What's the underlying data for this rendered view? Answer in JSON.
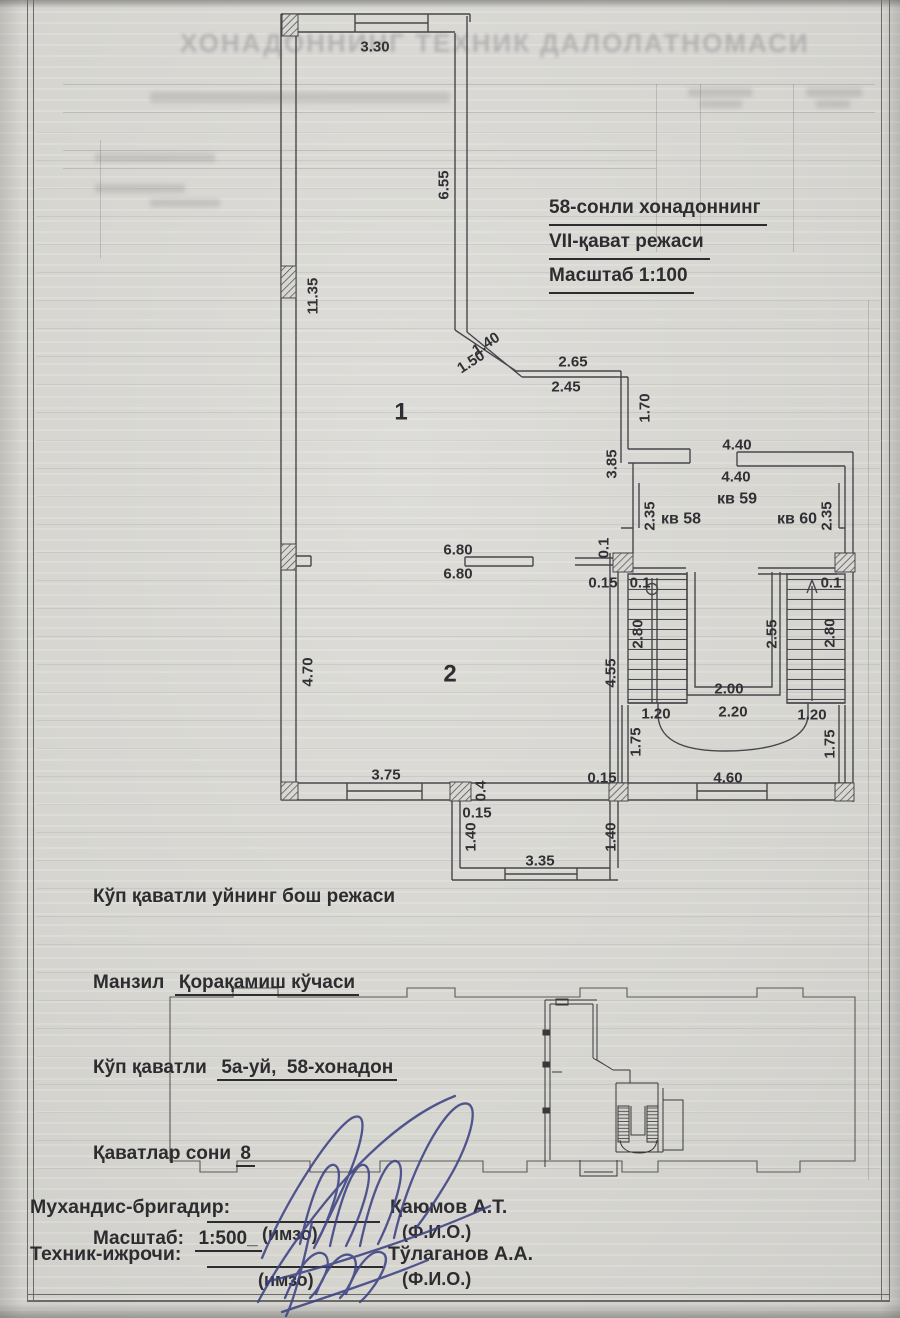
{
  "document": {
    "ghost_title": "ХОНАДОННИНГ ТЕХНИК ДАЛОЛАТНОМАСИ",
    "plan_title": {
      "line1": "58-сонли хонадоннинг",
      "line2": "VII-қават режаси",
      "line3": "Масштаб 1:100"
    },
    "site_info": {
      "line1": "Кўп қаватли уйнинг бош режаси",
      "address_label": "Манзил",
      "address_value": "Қорақамиш кўчаси",
      "building_label": "Кўп қаватли",
      "building_value": "5а-уй,  58-хонадон",
      "floors_label": "Қаватлар сони",
      "floors_value": "8",
      "scale_label": "Масштаб:",
      "scale_value": "1:500_"
    },
    "signatures": {
      "row1": {
        "role": "Мухандис-бригадир:",
        "sig_caption": "(имзо)",
        "name": "Қаюмов А.Т.",
        "fio_caption": "(Ф.И.О.)"
      },
      "row2": {
        "role": "Техник-ижрочи:",
        "sig_caption": "(имзо)",
        "name": "Тўлаганов А.А.",
        "fio_caption": "(Ф.И.О.)"
      }
    }
  },
  "plan": {
    "apartment_units": [
      "кв 58",
      "кв 59",
      "кв 60"
    ],
    "labels": [
      {
        "t": "3.30",
        "x": 375,
        "y": 47,
        "r": 0
      },
      {
        "t": "6.55",
        "x": 444,
        "y": 185,
        "r": -90
      },
      {
        "t": "11.35",
        "x": 313,
        "y": 296,
        "r": -90
      },
      {
        "t": "1.40",
        "x": 486,
        "y": 344,
        "r": -33
      },
      {
        "t": "1.50",
        "x": 471,
        "y": 362,
        "r": -33
      },
      {
        "t": "2.65",
        "x": 573,
        "y": 362,
        "r": 0
      },
      {
        "t": "2.45",
        "x": 566,
        "y": 387,
        "r": 0
      },
      {
        "t": "1.70",
        "x": 645,
        "y": 408,
        "r": -90
      },
      {
        "t": "3.85",
        "x": 612,
        "y": 464,
        "r": -90
      },
      {
        "t": "4.40",
        "x": 737,
        "y": 445,
        "r": 0
      },
      {
        "t": "4.40",
        "x": 736,
        "y": 477,
        "r": 0
      },
      {
        "t": "кв 59",
        "x": 737,
        "y": 499,
        "r": 0,
        "cls": "kv"
      },
      {
        "t": "кв 58",
        "x": 681,
        "y": 519,
        "r": 0,
        "cls": "kv"
      },
      {
        "t": "кв 60",
        "x": 797,
        "y": 519,
        "r": 0,
        "cls": "kv"
      },
      {
        "t": "2.35",
        "x": 650,
        "y": 516,
        "r": -90
      },
      {
        "t": "2.35",
        "x": 827,
        "y": 516,
        "r": -90
      },
      {
        "t": "0.1",
        "x": 604,
        "y": 548,
        "r": -90
      },
      {
        "t": "0.15",
        "x": 603,
        "y": 583,
        "r": 0
      },
      {
        "t": "0.1",
        "x": 640,
        "y": 583,
        "r": 0
      },
      {
        "t": "0.1",
        "x": 831,
        "y": 583,
        "r": 0
      },
      {
        "t": "2.80",
        "x": 638,
        "y": 634,
        "r": -90
      },
      {
        "t": "2.55",
        "x": 772,
        "y": 634,
        "r": -90
      },
      {
        "t": "2.80",
        "x": 830,
        "y": 633,
        "r": -90
      },
      {
        "t": "4.55",
        "x": 611,
        "y": 673,
        "r": -90
      },
      {
        "t": "2.00",
        "x": 729,
        "y": 689,
        "r": 0
      },
      {
        "t": "1.20",
        "x": 656,
        "y": 714,
        "r": 0
      },
      {
        "t": "2.20",
        "x": 733,
        "y": 712,
        "r": 0
      },
      {
        "t": "1.20",
        "x": 812,
        "y": 715,
        "r": 0
      },
      {
        "t": "1.75",
        "x": 636,
        "y": 742,
        "r": -90
      },
      {
        "t": "1.75",
        "x": 830,
        "y": 744,
        "r": -90
      },
      {
        "t": "0.15",
        "x": 602,
        "y": 778,
        "r": 0
      },
      {
        "t": "4.60",
        "x": 728,
        "y": 778,
        "r": 0
      },
      {
        "t": "6.80",
        "x": 458,
        "y": 550,
        "r": 0
      },
      {
        "t": "6.80",
        "x": 458,
        "y": 574,
        "r": 0
      },
      {
        "t": "4.70",
        "x": 308,
        "y": 672,
        "r": -90
      },
      {
        "t": "3.75",
        "x": 386,
        "y": 775,
        "r": 0
      },
      {
        "t": "0.4",
        "x": 481,
        "y": 791,
        "r": -90
      },
      {
        "t": "0.15",
        "x": 477,
        "y": 813,
        "r": 0
      },
      {
        "t": "1.40",
        "x": 471,
        "y": 837,
        "r": -90
      },
      {
        "t": "1.40",
        "x": 611,
        "y": 837,
        "r": -90
      },
      {
        "t": "3.35",
        "x": 540,
        "y": 861,
        "r": 0
      },
      {
        "t": "1",
        "x": 401,
        "y": 412,
        "r": 0,
        "cls": "room"
      },
      {
        "t": "2",
        "x": 450,
        "y": 674,
        "r": 0,
        "cls": "room"
      }
    ]
  },
  "colors": {
    "paper": "#d8d7d2",
    "ink": "#2d2d30",
    "plan_line": "#47474b",
    "signature_ink": "#3d4383"
  }
}
